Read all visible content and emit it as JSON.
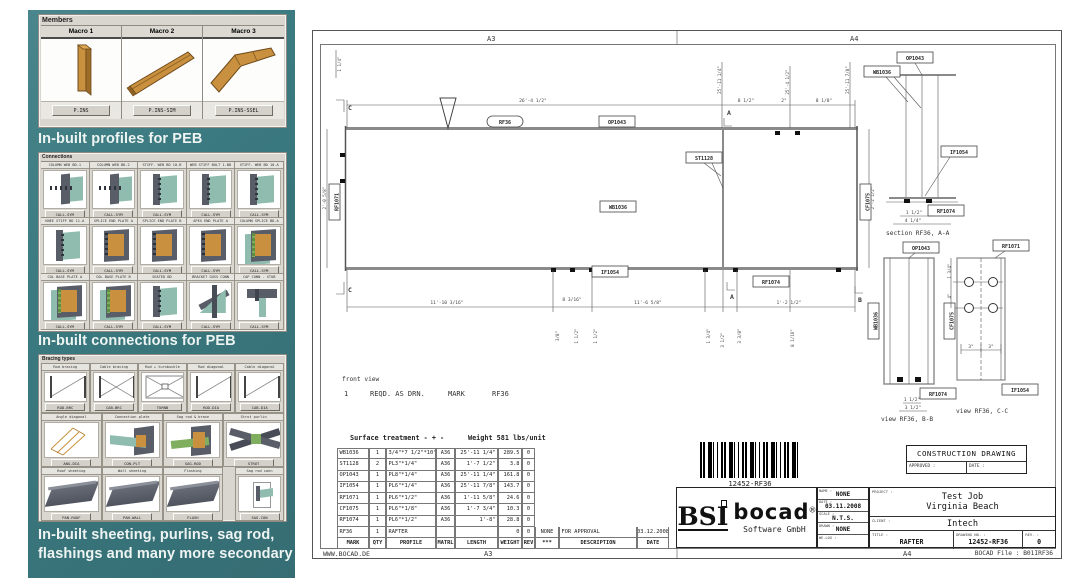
{
  "left_panel": {
    "members": {
      "title": "Members",
      "macros": [
        {
          "name": "Macro 1",
          "button": "P.INS",
          "variant": "m1"
        },
        {
          "name": "Macro 2",
          "button": "P.INS-SIM",
          "variant": "m2"
        },
        {
          "name": "Macro 3",
          "button": "P.INS-SSEL",
          "variant": "m3"
        }
      ]
    },
    "heading_profiles": "In-built profiles for PEB",
    "connections": {
      "title": "Connections",
      "cells": [
        {
          "label": "COLUMN WEB BD-1",
          "button": "CALL-SYM",
          "variant": "v1"
        },
        {
          "label": "COLUMN WEB BD-2",
          "button": "CALL-SYM",
          "variant": "v1"
        },
        {
          "label": "STIFF. WEB BD 10-B",
          "button": "CALL-SYM",
          "variant": "v2"
        },
        {
          "label": "WEB STIFF BOLT 1-BD",
          "button": "CALL-SYM",
          "variant": "v2"
        },
        {
          "label": "STIFF. WEB BD 10-A",
          "button": "CALL-SYM",
          "variant": "v2"
        },
        {
          "label": "KNEE STIFF BD 11-A",
          "button": "CALL-SYM",
          "variant": "v2"
        },
        {
          "label": "SPLICE END PLATE A",
          "button": "CALL-SYM",
          "variant": "v3"
        },
        {
          "label": "SPLICE END PLATE B",
          "button": "CALL-SYM",
          "variant": "v3"
        },
        {
          "label": "APEX END PLATE A",
          "button": "CALL-SYM",
          "variant": "v3"
        },
        {
          "label": "COLUMN SPLICE BD-A",
          "button": "CALL-SYM",
          "variant": "v4"
        },
        {
          "label": "COL BASE PLATE A",
          "button": "CALL-SYM",
          "variant": "v4"
        },
        {
          "label": "COL BASE PLATE B",
          "button": "CALL-SYM",
          "variant": "v4"
        },
        {
          "label": "SEATED BD",
          "button": "CALL-SYM",
          "variant": "v2"
        },
        {
          "label": "BRACKET GUSS CONN",
          "button": "CALL-SYM",
          "variant": "v5"
        },
        {
          "label": "CAP CONN - STUB",
          "button": "CALL-SYM",
          "variant": "v6"
        }
      ]
    },
    "heading_connections": "In-built connections for PEB",
    "bracing": {
      "title": "Bracing types",
      "row1": [
        {
          "label": "Rod bracing",
          "button": "ROD-BRC",
          "variant": "d1"
        },
        {
          "label": "Cable bracing",
          "button": "CAB-BRC",
          "variant": "d2"
        },
        {
          "label": "Rod + turnbuckle",
          "button": "TURNB",
          "variant": "d3"
        },
        {
          "label": "Rod diagonal",
          "button": "ROD-DIA",
          "variant": "d1"
        },
        {
          "label": "Cable diagonal",
          "button": "CAB-DIA",
          "variant": "d1"
        }
      ],
      "row2": [
        {
          "label": "Angle diagonal",
          "button": "ANG-DIA",
          "variant": "w1"
        },
        {
          "label": "Connection plate",
          "button": "CON-PLT",
          "variant": "w2"
        },
        {
          "label": "Sag rod & brace",
          "button": "SAG-ROD",
          "variant": "w3"
        },
        {
          "label": "Strut purlin",
          "button": "STRUT",
          "variant": "w4"
        }
      ],
      "row3": [
        {
          "label": "Roof sheeting",
          "button": "PAN-ROOF",
          "variant": "s1"
        },
        {
          "label": "Wall sheeting",
          "button": "PAN-WALL",
          "variant": "s1"
        },
        {
          "label": "Flashing",
          "button": "FLASH",
          "variant": "s1"
        }
      ],
      "row3b": [
        {
          "label": "Sag rod conn",
          "button": "SAG-CON",
          "variant": "w5"
        }
      ]
    },
    "heading_secondary": [
      "In-built sheeting, purlins, sag rod,",
      "flashings and many more secondary"
    ]
  },
  "drawing": {
    "zones": {
      "top_left": "A3",
      "top_right": "A4",
      "bottom_left": "A3",
      "bottom_right": "A4"
    },
    "website": "WWW.BOCAD.DE",
    "front_view": "front view",
    "reqd": {
      "qty": "1",
      "text": "REQD. AS DRN.",
      "mark_label": "MARK",
      "mark": "RF36"
    },
    "labels": {
      "rf36": "RF36",
      "op1043": "OP1043",
      "st1128": "ST1128",
      "wb1036": "WB1036",
      "if1054": "IF1054",
      "rf1074": "RF1074",
      "rf1071": "RF1071",
      "cf1075": "CF1075",
      "sec_a": "A",
      "sec_b": "B",
      "sec_c": "C"
    },
    "captions": {
      "section_aa": "section RF36, A-A",
      "view_bb": "view RF36, B-B",
      "view_cc": "view RF36, C-C"
    },
    "dims": [
      "26'-4 1/2\"",
      "8 1/2\"",
      "2\"",
      "8 1/8\"",
      "25'-11 1/4\"",
      "25'-4 1/2\"",
      "11'-10 3/16\"",
      "8 3/16\"",
      "11'-6 5/8\"",
      "1'-2 1/2\"",
      "2'-0 5/8\"",
      "2'-2 1/2\"",
      "1 1/2\"",
      "3 1/2\"",
      "1 3/4\"",
      "3 3/8\"",
      "8 1/16\"",
      "4 1/4\"",
      "1 1/2\"",
      "1 3/4\"",
      "4\"",
      "3\"",
      "3\"",
      "1 1/2\"",
      "3/8\"",
      "1 1/4\"",
      "25'-11 7/8\""
    ],
    "bom": {
      "surface": "Surface treatment - + -",
      "weight_note": "Weight 581 lbs/unit",
      "rows": [
        [
          "WB1036",
          "1",
          "3/4\"*7 1/2\"*10\"",
          "A36",
          "25'-11 1/4\"",
          "289.5",
          "0"
        ],
        [
          "ST1128",
          "2",
          "PL3\"*1/4\"",
          "A36",
          "1'-7 1/2\"",
          "3.8",
          "0"
        ],
        [
          "OP1043",
          "1",
          "PL8\"*1/4\"",
          "A36",
          "25'-11 1/4\"",
          "161.8",
          "0"
        ],
        [
          "IF1054",
          "1",
          "PL6\"*1/4\"",
          "A36",
          "25'-11 7/8\"",
          "143.7",
          "0"
        ],
        [
          "RF1071",
          "1",
          "PL6\"*1/2\"",
          "A36",
          "1'-11 5/8\"",
          "24.6",
          "0"
        ],
        [
          "CF1075",
          "1",
          "PL6\"*1/8\"",
          "A36",
          "1'-7 3/4\"",
          "10.3",
          "0"
        ],
        [
          "RF1074",
          "1",
          "PL6\"*1/2\"",
          "A36",
          "1'-8\"",
          "28.8",
          "0"
        ]
      ],
      "last_row": {
        "mark": "RF36",
        "qty": "1",
        "profile": "RAFTER",
        "matrl": "",
        "length": "",
        "weight": "0",
        "rev": "0",
        "zone": "NONE",
        "desc": "FOR APPROVAL",
        "date": "03.12.2008"
      },
      "headers": {
        "mark": "MARK",
        "qty": "QTY",
        "profile": "PROFILE",
        "matrl": "MATRL",
        "length": "LENGTH",
        "weight": "WEIGHT",
        "rev": "REV",
        "zone": "***",
        "desc": "DESCRIPTION",
        "date": "DATE"
      }
    },
    "barcode_text": "12452-RF36",
    "title_block": {
      "construction_drawing": "CONSTRUCTION DRAWING",
      "approved_label": "APPROVED :",
      "date_label": "DATE :",
      "logo": {
        "bsi": "BSI",
        "bocad": "bocad",
        "reg": "®",
        "subtitle": "Software GmbH"
      },
      "fields": [
        {
          "label": "NAME :",
          "value": "NONE"
        },
        {
          "label": "DATE :",
          "value": "03.11.2008"
        },
        {
          "label": "SCALE :",
          "value": "N.T.S."
        },
        {
          "label": "DRAWN :",
          "value": "NONE"
        },
        {
          "label": "WE-LOG :",
          "value": ""
        }
      ],
      "project_label": "PROJECT :",
      "project_line1": "Test Job",
      "project_line2": "Virginia Beach",
      "client_label": "CLIENT :",
      "client": "Intech",
      "title_label": "TITLE :",
      "title": "RAFTER",
      "number_label": "DRAWING NO. :",
      "number": "12452-RF36",
      "rev_label": "REV. :",
      "rev": "0",
      "file_note": "BOCAD File : B01IRF36"
    }
  }
}
